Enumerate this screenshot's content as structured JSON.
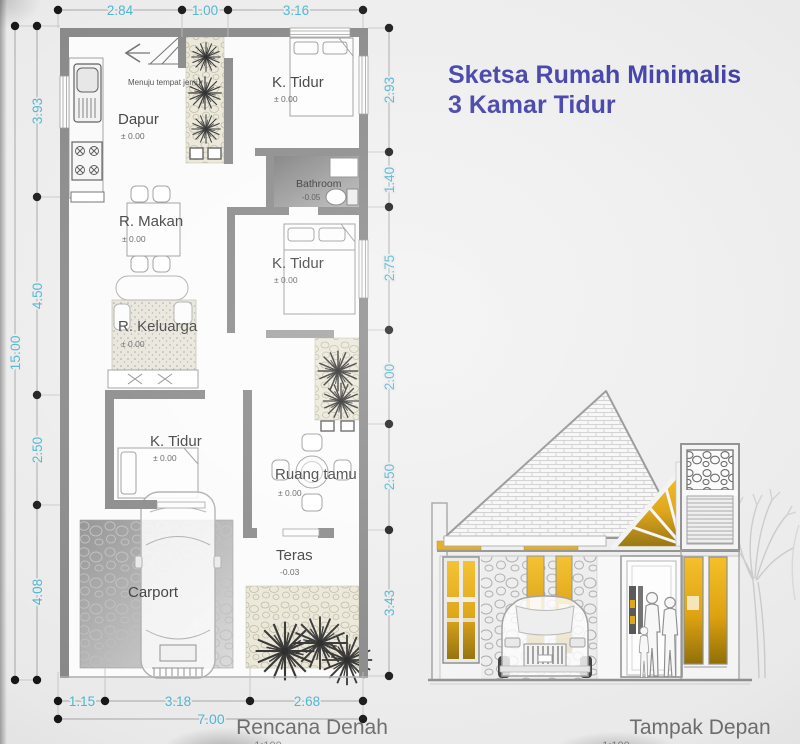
{
  "title": {
    "line1": "Sketsa Rumah Minimalis",
    "line2": "3 Kamar Tidur"
  },
  "colors": {
    "title_blue": "#3c3aa6",
    "dimension_cyan": "#4bb4ce",
    "wall_gray": "#878787",
    "accent_gold": "#e2a60f",
    "label_gray": "#6c6c6c"
  },
  "plan": {
    "label": "Rencana Denah",
    "scale": "1:100",
    "annotation": "Menuju tempat jemur",
    "rooms": {
      "dapur": {
        "name": "Dapur",
        "level": "± 0.00"
      },
      "k_tidur_1": {
        "name": "K. Tidur",
        "level": "± 0.00"
      },
      "bathroom": {
        "name": "Bathroom",
        "level": "-0.05"
      },
      "r_makan": {
        "name": "R. Makan",
        "level": "± 0.00"
      },
      "k_tidur_2": {
        "name": "K. Tidur",
        "level": "± 0.00"
      },
      "r_keluarga": {
        "name": "R. Keluarga",
        "level": "± 0.00"
      },
      "k_tidur_3": {
        "name": "K. Tidur",
        "level": "± 0.00"
      },
      "ruang_tamu": {
        "name": "Ruang tamu",
        "level": "± 0.00"
      },
      "teras": {
        "name": "Teras",
        "level": "-0.03"
      },
      "carport": {
        "name": "Carport"
      }
    },
    "dimensions": {
      "top": [
        "2.84",
        "1.00",
        "3.16"
      ],
      "left": [
        "3.93",
        "4.50",
        "2.50",
        "4.08"
      ],
      "left_total": "15.00",
      "right": [
        "2.93",
        "1.40",
        "2.75",
        "2.00",
        "2.50",
        "3.43"
      ],
      "bottom": [
        "1.15",
        "3.18",
        "2.68"
      ],
      "bottom_total": "7.00"
    }
  },
  "elevation": {
    "label": "Tampak Depan",
    "scale": "1:100"
  }
}
